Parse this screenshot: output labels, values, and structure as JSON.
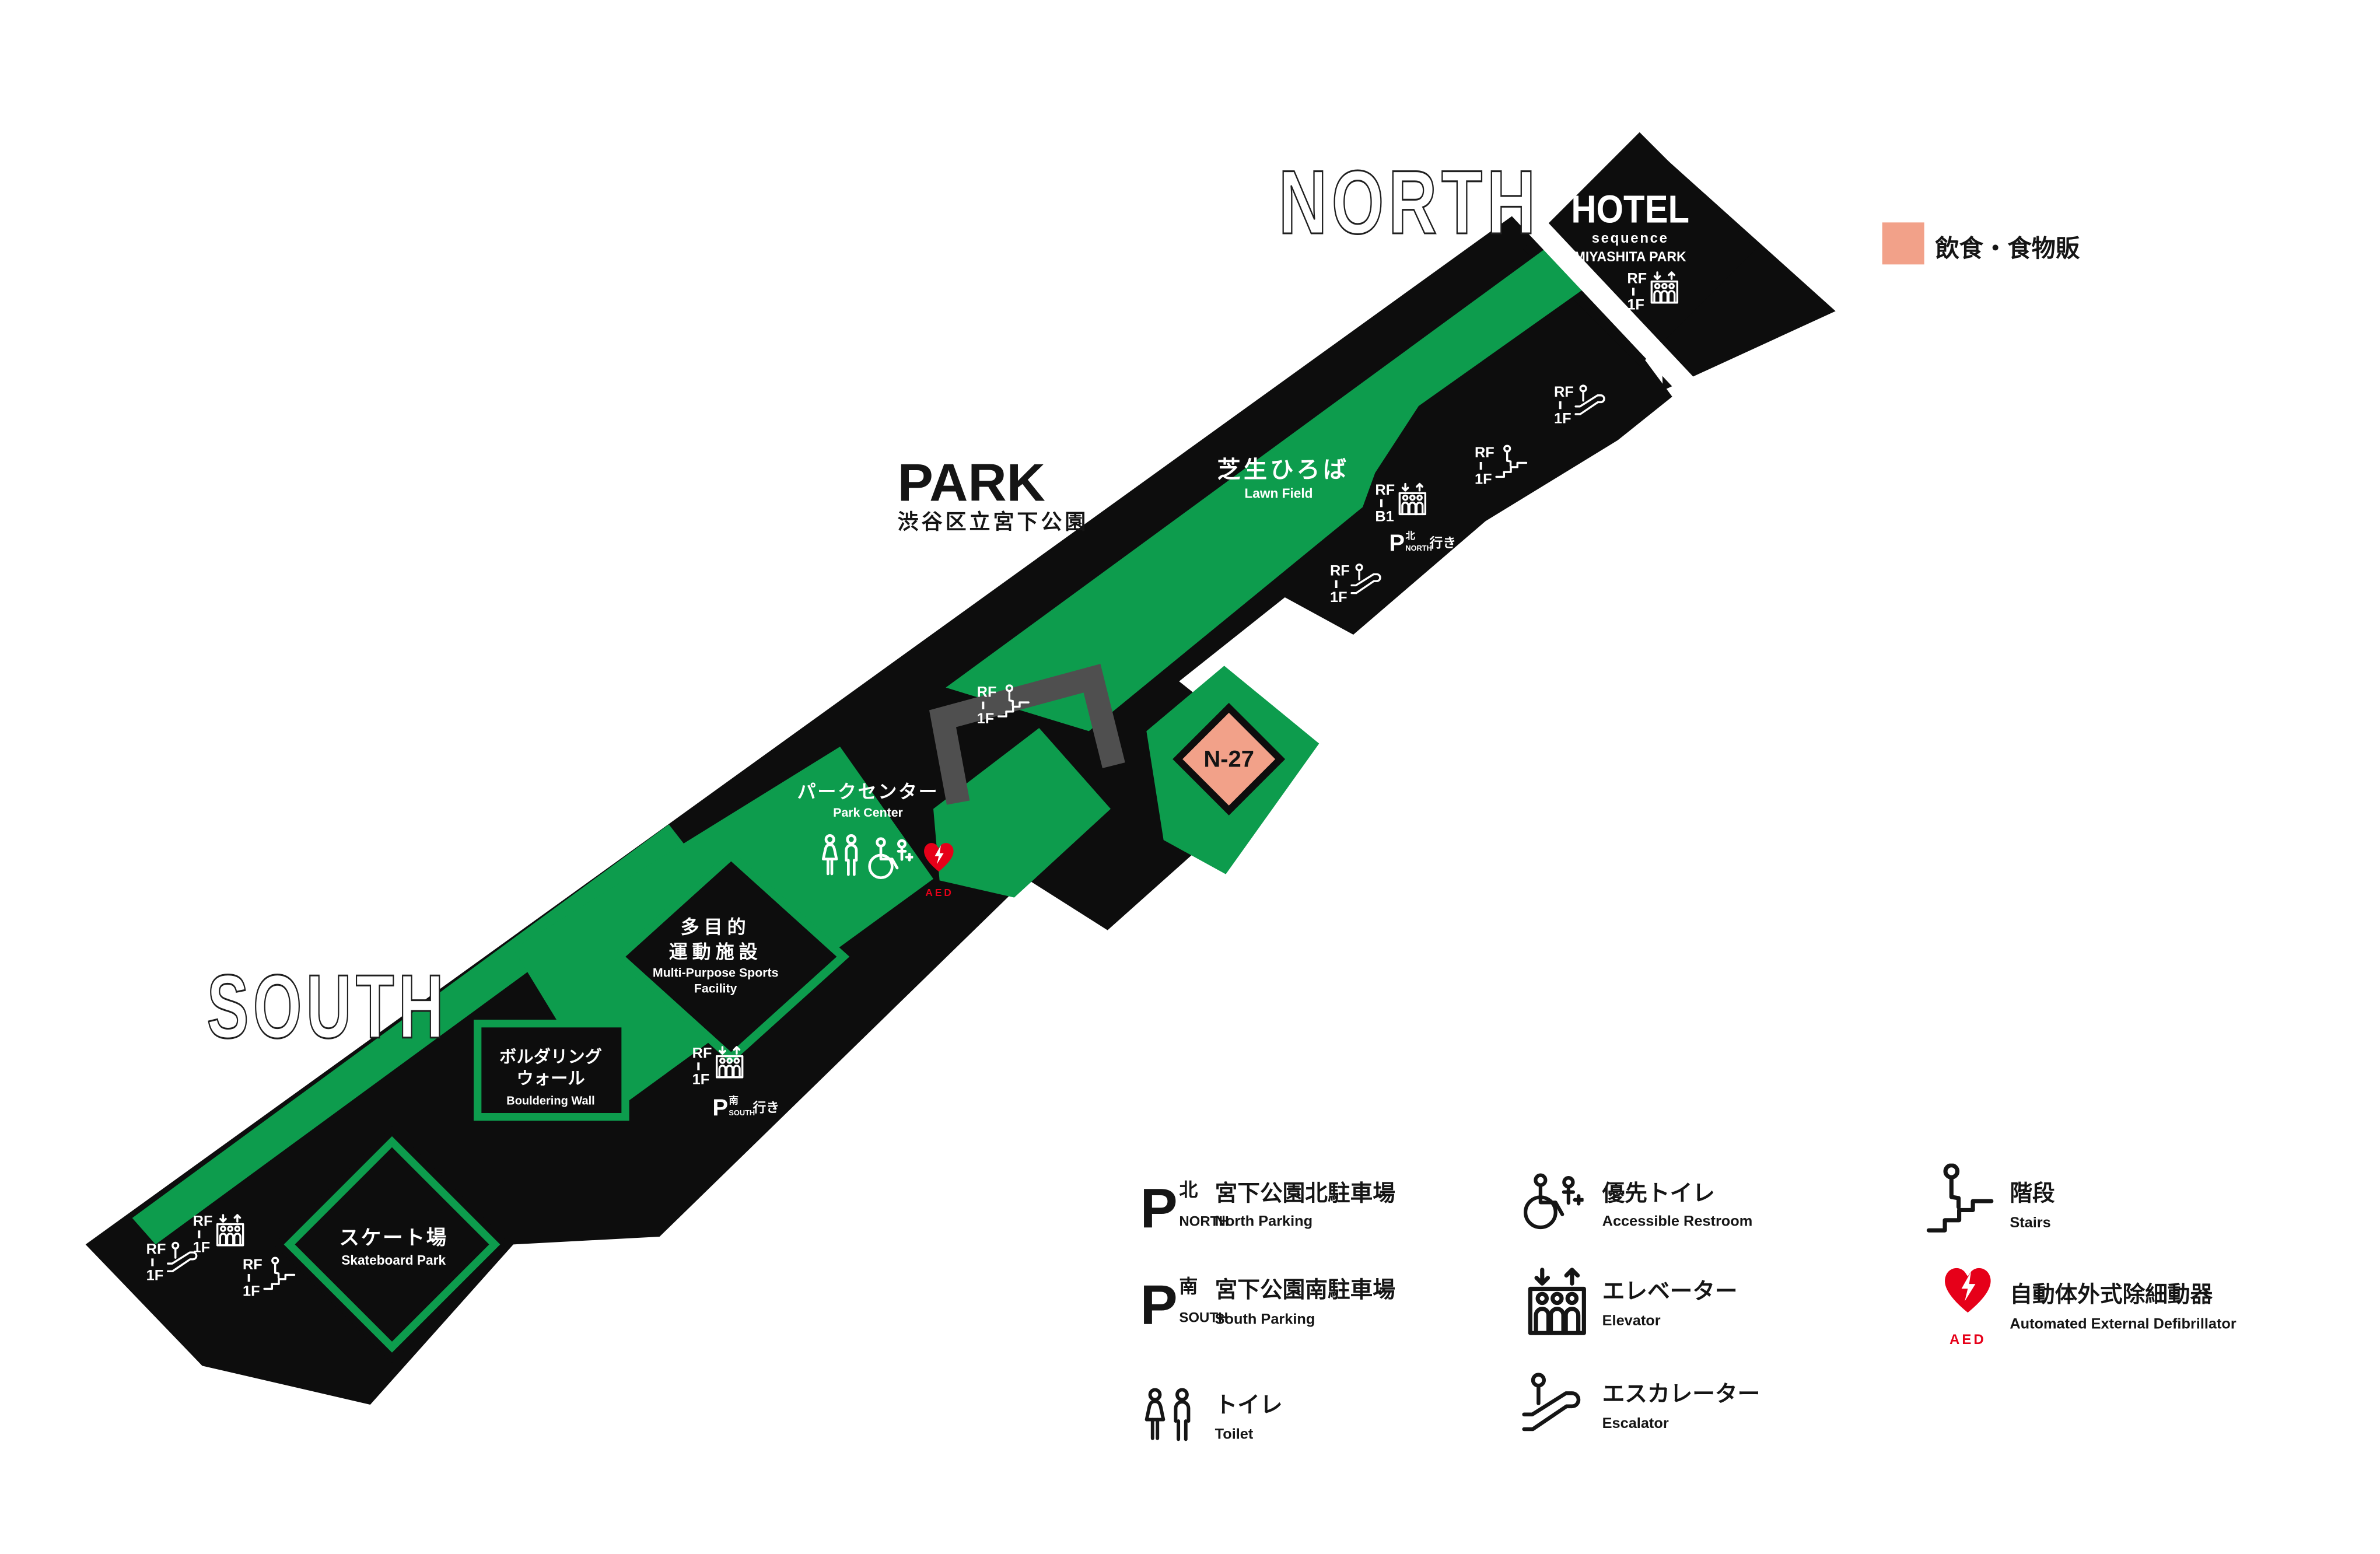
{
  "colors": {
    "green": "#0D9C4D",
    "black": "#0D0D0D",
    "grey": "#4F4F4F",
    "pink": "#F2A189",
    "red": "#E60019",
    "white": "#FFFFFF",
    "text_black": "#151515"
  },
  "legend_top": {
    "label": "飲食・食物販"
  },
  "compass": {
    "north": "NORTH",
    "south": "SOUTH"
  },
  "park_title": {
    "en": "PARK",
    "jp": "渋谷区立宮下公園"
  },
  "hotel": {
    "name": "HOTEL",
    "brand": "sequence",
    "sub": "MIYASHITA PARK"
  },
  "places": {
    "lawn_jp": "芝生ひろば",
    "lawn_en": "Lawn Field",
    "park_center_jp": "パークセンター",
    "park_center_en": "Park Center",
    "sports_jp1": "多目的",
    "sports_jp2": "運動施設",
    "sports_en1": "Multi-Purpose Sports",
    "sports_en2": "Facility",
    "bouldering_jp1": "ボルダリング",
    "bouldering_jp2": "ウォール",
    "bouldering_en": "Bouldering Wall",
    "skate_jp": "スケート場",
    "skate_en": "Skateboard Park",
    "n27": "N-27",
    "aed": "AED"
  },
  "floor_labels": {
    "rf": "RF",
    "f1": "1F",
    "b1": "B1"
  },
  "parking_tags": {
    "letter": "P",
    "north_jp": "北",
    "north_en": "NORTH",
    "south_jp": "南",
    "south_en": "SOUTH",
    "bound": "行き"
  },
  "legend": {
    "items": [
      {
        "jp": "宮下公園北駐車場",
        "en": "North Parking"
      },
      {
        "jp": "宮下公園南駐車場",
        "en": "South Parking"
      },
      {
        "jp": "トイレ",
        "en": "Toilet"
      },
      {
        "jp": "優先トイレ",
        "en": "Accessible Restroom"
      },
      {
        "jp": "エレベーター",
        "en": "Elevator"
      },
      {
        "jp": "エスカレーター",
        "en": "Escalator"
      },
      {
        "jp": "階段",
        "en": "Stairs"
      },
      {
        "jp": "自動体外式除細動器",
        "en": "Automated External Defibrillator"
      }
    ]
  }
}
